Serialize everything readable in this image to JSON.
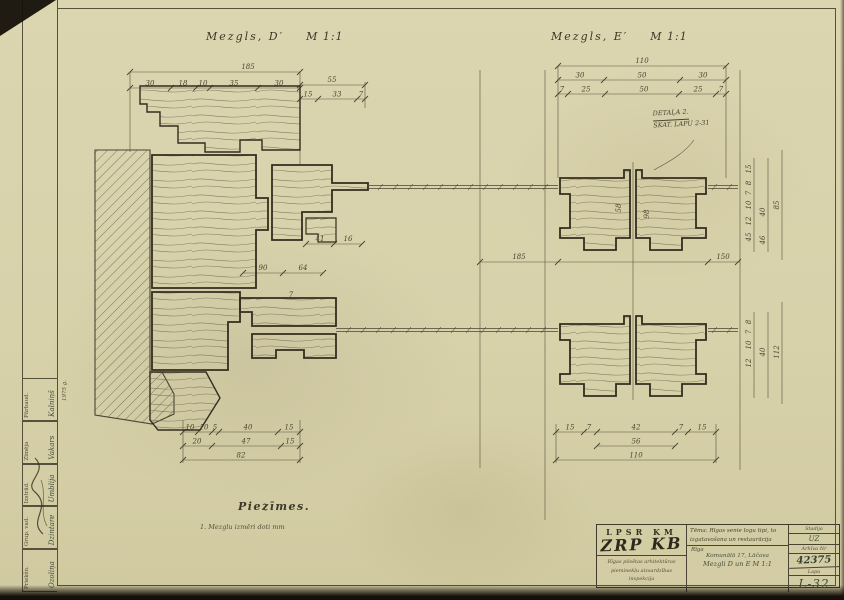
{
  "titles": {
    "left": "Mezgls, D′",
    "left_scale": "M 1:1",
    "right": "Mezgls, E′",
    "right_scale": "M 1:1"
  },
  "detail_callout": {
    "line1": "DETAĻA 2.",
    "line2": "SKAT. LAPU 2-31"
  },
  "notes": {
    "heading": "Piezīmes.",
    "item1": "1. Mezglu izmēri doti mm"
  },
  "dims": {
    "lt_total": "185",
    "lt_row": [
      "30",
      "18",
      "10",
      "35",
      "30"
    ],
    "lt_55": "55",
    "lt_sub": [
      "15",
      "33",
      "7"
    ],
    "rt_total": "110",
    "rt_row": [
      "30",
      "50",
      "30"
    ],
    "rt_sub": [
      "7",
      "25",
      "50",
      "25",
      "7"
    ],
    "lm": [
      "41",
      "16",
      "90",
      "64",
      "7"
    ],
    "lb_row1": [
      "10",
      "10",
      "5",
      "40",
      "15"
    ],
    "lb_row2": [
      "20",
      "47",
      "15"
    ],
    "lb_total": "82",
    "rb_row1": [
      "15",
      "7",
      "42",
      "7",
      "15"
    ],
    "rb_mid": "56",
    "rb_total": "110",
    "mid_left": "185",
    "mid_right": "150",
    "rv_top": [
      "15",
      "8",
      "7",
      "10",
      "12",
      "45",
      "40",
      "46",
      "85"
    ],
    "rv_bot": [
      "8",
      "7",
      "10",
      "12",
      "40",
      "112"
    ],
    "inner": [
      "58",
      "98"
    ]
  },
  "sidebar": {
    "cells": [
      {
        "label": "Priekšn.",
        "name": "Ozoliņa"
      },
      {
        "label": "Grup. vad.",
        "name": "Dzintare"
      },
      {
        "label": "Izstrād.",
        "name": "Umblija"
      },
      {
        "label": "Zīmēja",
        "name": "Vakars"
      },
      {
        "label": "Pārbaud.",
        "name": "Kalniņš"
      }
    ],
    "year": "1975 g."
  },
  "titleblock": {
    "org_top": "LPSR  KM",
    "org_big": "ZRP KB",
    "org_small1": "Rīgas pilsētas arhitektūras",
    "org_small2": "pieminekļu aizsardzības",
    "org_small3": "inspekcija",
    "theme1": "Tēma: Rīgas senie logu tipi, to",
    "theme2": "izgatavošana un restaurācija",
    "city": "Rīga",
    "object": "Komunālā 17, Lāčava",
    "subject": "Mezgli D un E   M 1:1",
    "stage_label": "Stadija",
    "stage": "UZ",
    "arch_label": "Arhīva Nr",
    "arch_no": "42375",
    "sheet_label": "Lapa",
    "sheet_no": "L-32"
  }
}
